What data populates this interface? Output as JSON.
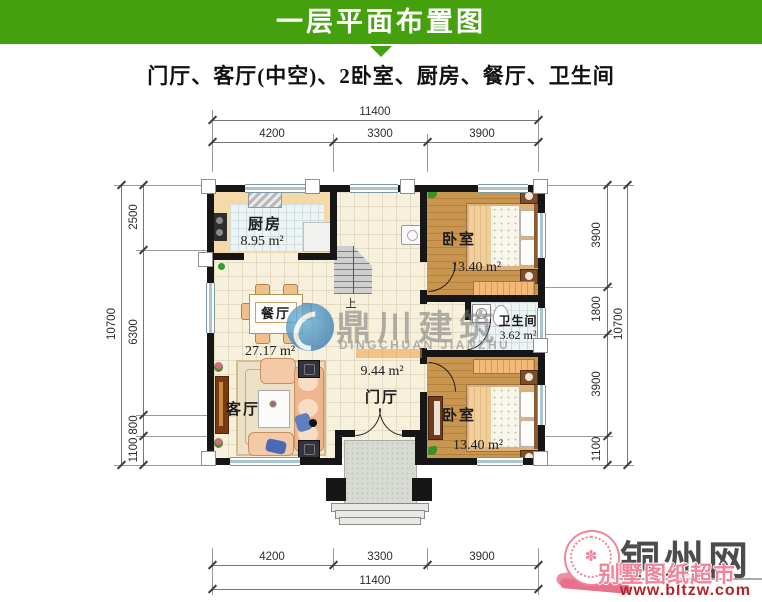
{
  "header": {
    "title": "一层平面布置图",
    "subtitle": "门厅、客厅(中空)、2卧室、厨房、餐厅、卫生间"
  },
  "dimensions": {
    "top": {
      "overall": "11400",
      "segments": [
        "4200",
        "3300",
        "3900"
      ]
    },
    "bottom": {
      "overall": "11400",
      "segments": [
        "4200",
        "3300",
        "3900"
      ]
    },
    "left": {
      "overall": "10700",
      "segments": [
        "2500",
        "6300",
        "800",
        "1100"
      ]
    },
    "right": {
      "overall": "10700",
      "segments": [
        "3900",
        "1800",
        "3900",
        "1100"
      ]
    }
  },
  "rooms": {
    "kitchen": {
      "name": "厨房",
      "area": "8.95 m²"
    },
    "dining": {
      "name": "餐厅",
      "area": "27.17 m²"
    },
    "living": {
      "name": "客厅"
    },
    "foyer": {
      "name": "门厅",
      "area": "9.44 m²"
    },
    "bedroom_top": {
      "name": "卧室",
      "area": "13.40 m²"
    },
    "bathroom": {
      "name": "卫生间",
      "area": "3.62 m²"
    },
    "bedroom_bottom": {
      "name": "卧室",
      "area": "13.40 m²"
    },
    "stairs": {
      "direction_label": "上"
    }
  },
  "watermark": {
    "cn": "鼎川建筑",
    "en": "DINGCHUAN JIANZHU"
  },
  "branding": {
    "site": "铜州网",
    "tagline": "别墅图纸超市",
    "url": "www.bltzw.com",
    "seal_glyph": "✽"
  },
  "colors": {
    "header_green": "#45a00d",
    "wall": "#161616",
    "brand_gray": "#4c4c4c",
    "brand_pink": "#f0849b",
    "brand_red": "#b2242a",
    "watermark_blue": "#4796c8"
  }
}
